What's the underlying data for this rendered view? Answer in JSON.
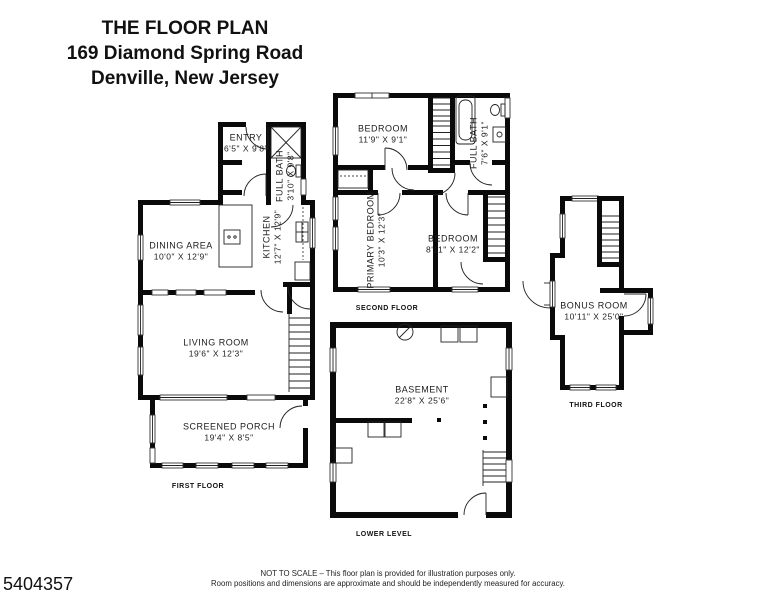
{
  "title": {
    "line1": "THE FLOOR PLAN",
    "line2": "169 Diamond Spring Road",
    "line3": "Denville, New Jersey"
  },
  "listing_id": "5404357",
  "disclaimer": {
    "line1": "NOT TO SCALE – This floor plan is provided for illustration purposes only.",
    "line2": "Room positions and dimensions are approximate and should be independently measured for accuracy."
  },
  "floors": {
    "first": {
      "label": "FIRST FLOOR",
      "rooms": {
        "entry": {
          "name": "ENTRY",
          "dims": "6'5\" X 9'8\""
        },
        "full_bath": {
          "name": "FULL BATH",
          "dims": "3'10\" X 9'8\""
        },
        "dining_area": {
          "name": "DINING AREA",
          "dims": "10'0\" X 12'9\""
        },
        "kitchen": {
          "name": "KITCHEN",
          "dims": "12'7\" X 12'9\""
        },
        "living_room": {
          "name": "LIVING ROOM",
          "dims": "19'6\" X 12'3\""
        },
        "screened_porch": {
          "name": "SCREENED PORCH",
          "dims": "19'4\" X 8'5\""
        }
      }
    },
    "second": {
      "label": "SECOND FLOOR",
      "rooms": {
        "bedroom_top": {
          "name": "BEDROOM",
          "dims": "11'9\" X 9'1\""
        },
        "full_bath": {
          "name": "FULL BATH",
          "dims": "7'6\" X 9'1\""
        },
        "primary_bedroom": {
          "name": "PRIMARY BEDROOM",
          "dims": "10'3\" X 12'3\""
        },
        "bedroom_right": {
          "name": "BEDROOM",
          "dims": "8'11\" X 12'2\""
        }
      }
    },
    "third": {
      "label": "THIRD FLOOR",
      "rooms": {
        "bonus_room": {
          "name": "BONUS ROOM",
          "dims": "10'11\" X 25'0\""
        }
      }
    },
    "lower": {
      "label": "LOWER LEVEL",
      "rooms": {
        "basement": {
          "name": "BASEMENT",
          "dims": "22'8\" X 25'6\""
        }
      }
    }
  },
  "colors": {
    "wall": "#000000",
    "background": "#ffffff",
    "text": "#1a1a1a"
  }
}
